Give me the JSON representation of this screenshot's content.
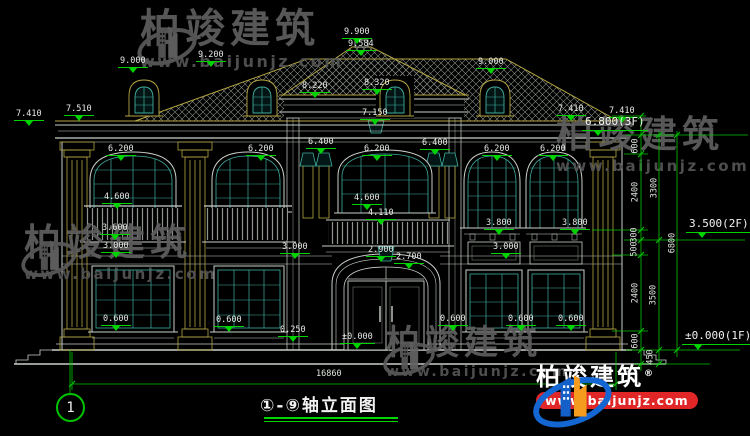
{
  "drawing": {
    "title": "①-⑨轴立面图",
    "axis_start": "1"
  },
  "watermark": {
    "company": "柏竣建筑",
    "url": "www.baijunjz.com"
  },
  "brand_logo": {
    "company": "柏竣建筑",
    "reg": "®",
    "url": "www.baijunjz.com"
  },
  "colors": {
    "line": "#c9cfc9",
    "trim": "#b5a642",
    "glass": "#3fae9f",
    "dimension": "#00d400",
    "watermark_gray": "#5e5e5e",
    "brand_blue": "#1467d2",
    "brand_orange": "#f59b1e",
    "brand_red": "#e02626"
  },
  "annotations": [
    {
      "text": "7.410",
      "x": 14,
      "y": 110,
      "type": "level"
    },
    {
      "text": "7.510",
      "x": 64,
      "y": 105,
      "type": "level"
    },
    {
      "text": "9.000",
      "x": 118,
      "y": 57,
      "type": "level"
    },
    {
      "text": "9.200",
      "x": 196,
      "y": 51,
      "type": "level"
    },
    {
      "text": "9.900",
      "x": 342,
      "y": 28,
      "type": "level"
    },
    {
      "text": "9.584",
      "x": 346,
      "y": 40,
      "type": "level"
    },
    {
      "text": "8.220",
      "x": 300,
      "y": 82,
      "type": "level"
    },
    {
      "text": "8.320",
      "x": 362,
      "y": 79,
      "type": "level"
    },
    {
      "text": "9.000",
      "x": 476,
      "y": 58,
      "type": "level"
    },
    {
      "text": "7.150",
      "x": 360,
      "y": 109,
      "type": "level"
    },
    {
      "text": "7.410",
      "x": 556,
      "y": 105,
      "type": "level"
    },
    {
      "text": "7.410",
      "x": 607,
      "y": 107,
      "type": "level"
    },
    {
      "text": "6.800(3F)",
      "x": 582,
      "y": 116,
      "type": "floor"
    },
    {
      "text": "6.200",
      "x": 106,
      "y": 145,
      "type": "level"
    },
    {
      "text": "6.200",
      "x": 246,
      "y": 145,
      "type": "level"
    },
    {
      "text": "6.400",
      "x": 306,
      "y": 138,
      "type": "level"
    },
    {
      "text": "6.200",
      "x": 362,
      "y": 145,
      "type": "level"
    },
    {
      "text": "6.400",
      "x": 420,
      "y": 139,
      "type": "level"
    },
    {
      "text": "6.200",
      "x": 482,
      "y": 145,
      "type": "level"
    },
    {
      "text": "6.200",
      "x": 538,
      "y": 145,
      "type": "level"
    },
    {
      "text": "4.600",
      "x": 102,
      "y": 193,
      "type": "level"
    },
    {
      "text": "4.600",
      "x": 352,
      "y": 194,
      "type": "level"
    },
    {
      "text": "4.110",
      "x": 366,
      "y": 209,
      "type": "level"
    },
    {
      "text": "3.600",
      "x": 100,
      "y": 224,
      "type": "level"
    },
    {
      "text": "3.800",
      "x": 484,
      "y": 219,
      "type": "level"
    },
    {
      "text": "3.800",
      "x": 560,
      "y": 219,
      "type": "level"
    },
    {
      "text": "3.000",
      "x": 101,
      "y": 242,
      "type": "level"
    },
    {
      "text": "3.000",
      "x": 280,
      "y": 243,
      "type": "level"
    },
    {
      "text": "2.900",
      "x": 366,
      "y": 246,
      "type": "level"
    },
    {
      "text": "2.700",
      "x": 394,
      "y": 253,
      "type": "level"
    },
    {
      "text": "3.000",
      "x": 491,
      "y": 243,
      "type": "level"
    },
    {
      "text": "3.500(2F)",
      "x": 686,
      "y": 218,
      "type": "floor"
    },
    {
      "text": "0.600",
      "x": 101,
      "y": 315,
      "type": "level"
    },
    {
      "text": "0.600",
      "x": 214,
      "y": 316,
      "type": "level"
    },
    {
      "text": "0.250",
      "x": 278,
      "y": 326,
      "type": "level"
    },
    {
      "text": "0.600",
      "x": 438,
      "y": 315,
      "type": "level"
    },
    {
      "text": "0.600",
      "x": 506,
      "y": 315,
      "type": "level"
    },
    {
      "text": "0.600",
      "x": 556,
      "y": 315,
      "type": "level"
    },
    {
      "text": "±0.000",
      "x": 340,
      "y": 333,
      "type": "level"
    },
    {
      "text": "±0.000(1F)",
      "x": 682,
      "y": 330,
      "type": "floor"
    },
    {
      "text": "16860",
      "x": 316,
      "y": 370,
      "type": "dim"
    },
    {
      "text": "600",
      "x": 636,
      "y": 146,
      "type": "dim",
      "rot": true
    },
    {
      "text": "2400",
      "x": 636,
      "y": 192,
      "type": "dim",
      "rot": true
    },
    {
      "text": "300",
      "x": 635,
      "y": 235,
      "type": "dim",
      "rot": true
    },
    {
      "text": "500",
      "x": 635,
      "y": 249,
      "type": "dim",
      "rot": true
    },
    {
      "text": "2400",
      "x": 636,
      "y": 293,
      "type": "dim",
      "rot": true
    },
    {
      "text": "600",
      "x": 636,
      "y": 341,
      "type": "dim",
      "rot": true
    },
    {
      "text": "450",
      "x": 651,
      "y": 357,
      "type": "dim",
      "rot": true
    },
    {
      "text": "3300",
      "x": 655,
      "y": 188,
      "type": "dim",
      "rot": true
    },
    {
      "text": "3500",
      "x": 654,
      "y": 295,
      "type": "dim",
      "rot": true
    },
    {
      "text": "6800",
      "x": 673,
      "y": 243,
      "type": "dim",
      "rot": true
    }
  ]
}
